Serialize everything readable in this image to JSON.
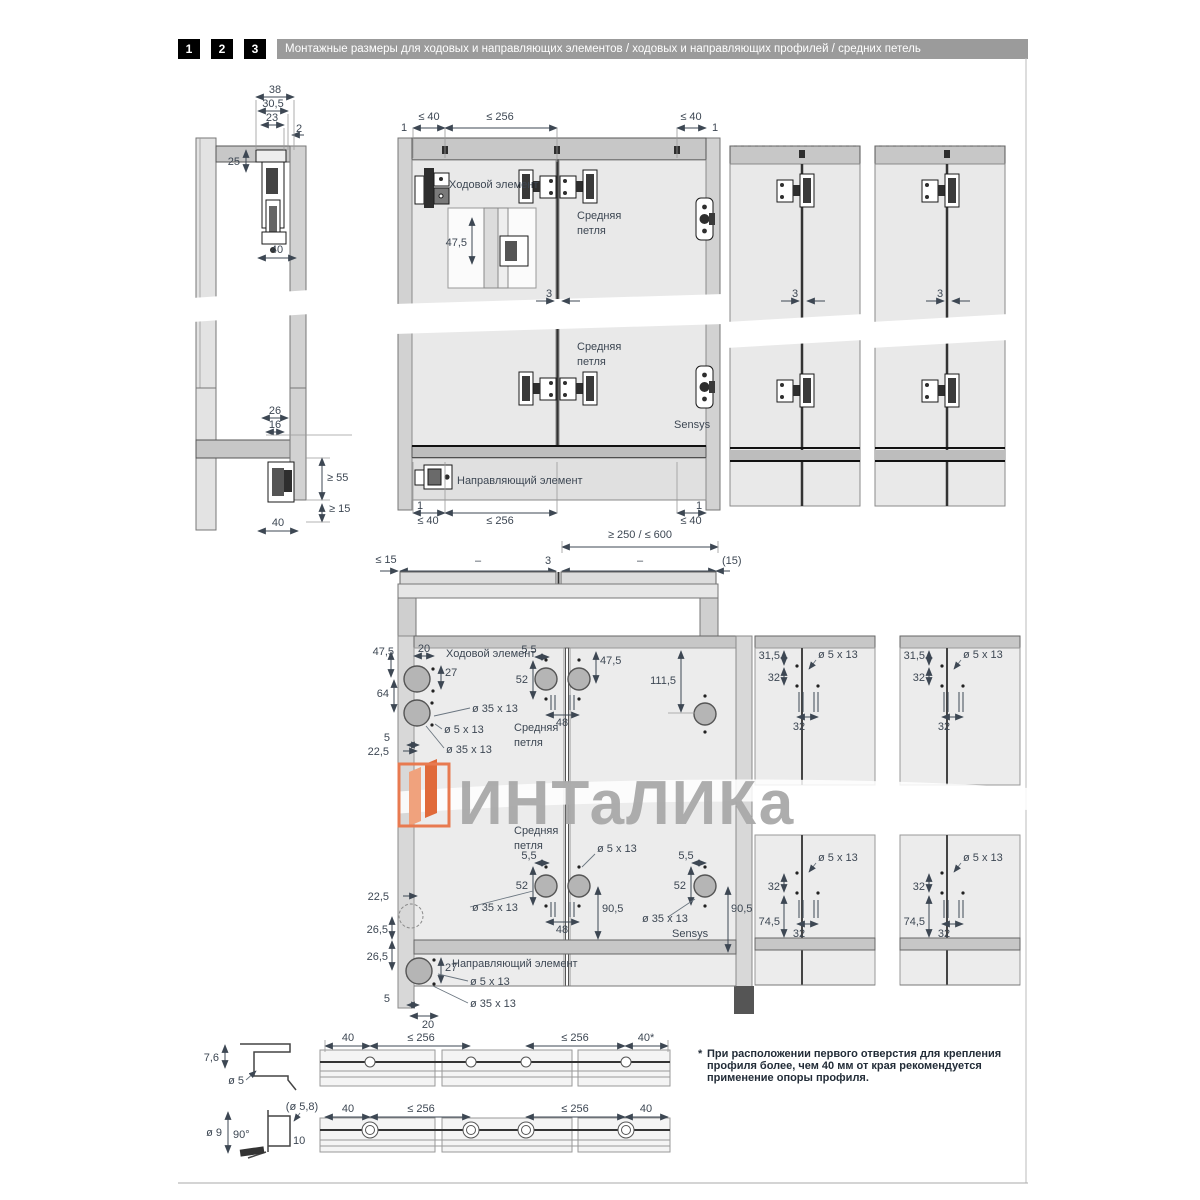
{
  "header": {
    "n1": "1",
    "n2": "2",
    "n3": "3",
    "title": "Монтажные размеры для ходовых и направляющих элементов / ходовых и направляющих профилей / средних петель"
  },
  "watermark": {
    "text": "ИНТаЛИКа"
  },
  "footnote": {
    "star": "*",
    "l1": "При расположении первого отверстия для крепления",
    "l2": "профиля более, чем 40 мм от края рекомендуется",
    "l3": "применение опоры профиля."
  },
  "d": {
    "lt": {
      "d38": "38",
      "d305": "30,5",
      "d23": "23",
      "d2": "2",
      "d25": "25",
      "d40": "40"
    },
    "lb": {
      "d26": "26",
      "d16": "16",
      "ge55": "≥ 55",
      "ge15": "≥ 15",
      "d40": "40"
    },
    "fv": {
      "one": "1",
      "le40": "≤ 40",
      "le256": "≤ 256",
      "runner": "Ходовой элемент",
      "sr1": "Средняя",
      "sr2": "петля",
      "d475": "47,5",
      "g3": "3",
      "sensys": "Sensys",
      "guide": "Направляющий элемент",
      "range": "≥ 250 / ≤ 600"
    },
    "pv": {
      "le15": "≤ 15",
      "dash": "–",
      "g3": "3",
      "p15": "(15)"
    },
    "dr": {
      "d475": "47,5",
      "d20": "20",
      "runner": "Ходовой элемент",
      "d27": "27",
      "d64": "64",
      "d5": "5",
      "d225": "22,5",
      "o35": "ø 35 x 13",
      "o5": "ø 5 x 13",
      "sr1": "Средняя",
      "sr2": "петля",
      "d55": "5,5",
      "d52": "52",
      "d48": "48",
      "d1115": "111,5",
      "d905": "90,5",
      "d265": "26,5",
      "guide": "Направляющий элемент",
      "sensys": "Sensys"
    },
    "rt": {
      "d315": "31,5",
      "d32": "32",
      "o5": "ø 5 x 13"
    },
    "rb": {
      "d745": "74,5",
      "d32": "32",
      "o5": "ø 5 x 13"
    },
    "p1": {
      "d76": "7,6",
      "d5": "ø 5",
      "d40": "40",
      "le256": "≤ 256",
      "d40s": "40*"
    },
    "p2": {
      "d58": "(ø 5,8)",
      "d9": "ø 9",
      "a90": "90°",
      "d10": "10",
      "d40": "40",
      "le256": "≤ 256"
    }
  }
}
